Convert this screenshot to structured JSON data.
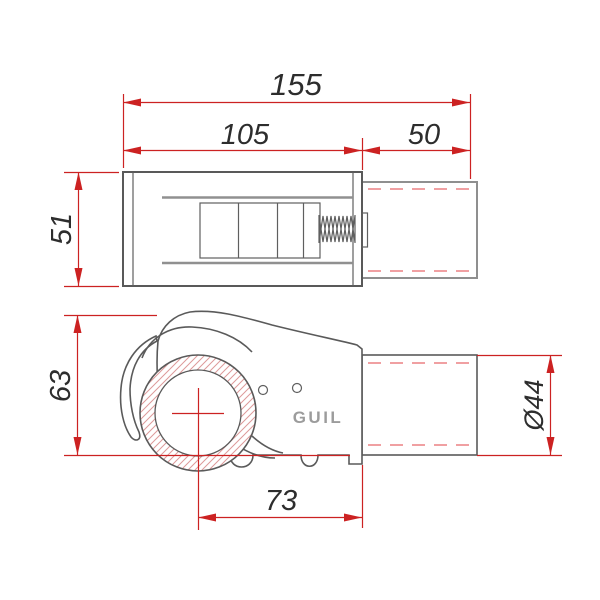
{
  "brand": {
    "logo": "GUIL"
  },
  "dimensions": {
    "total_length": "155",
    "body_length": "105",
    "tube_length": "50",
    "body_height": "51",
    "overall_height": "63",
    "center_to_end": "73",
    "tube_diameter": "Ø44"
  },
  "colors": {
    "dimension_red": "#cc2222",
    "centerline_pink": "#f0a0a2",
    "outline_gray": "#5a5a5a",
    "inner_line_gray": "#909090",
    "logo_gray": "#9c9c9c",
    "text_dark": "#2d2d2d"
  }
}
